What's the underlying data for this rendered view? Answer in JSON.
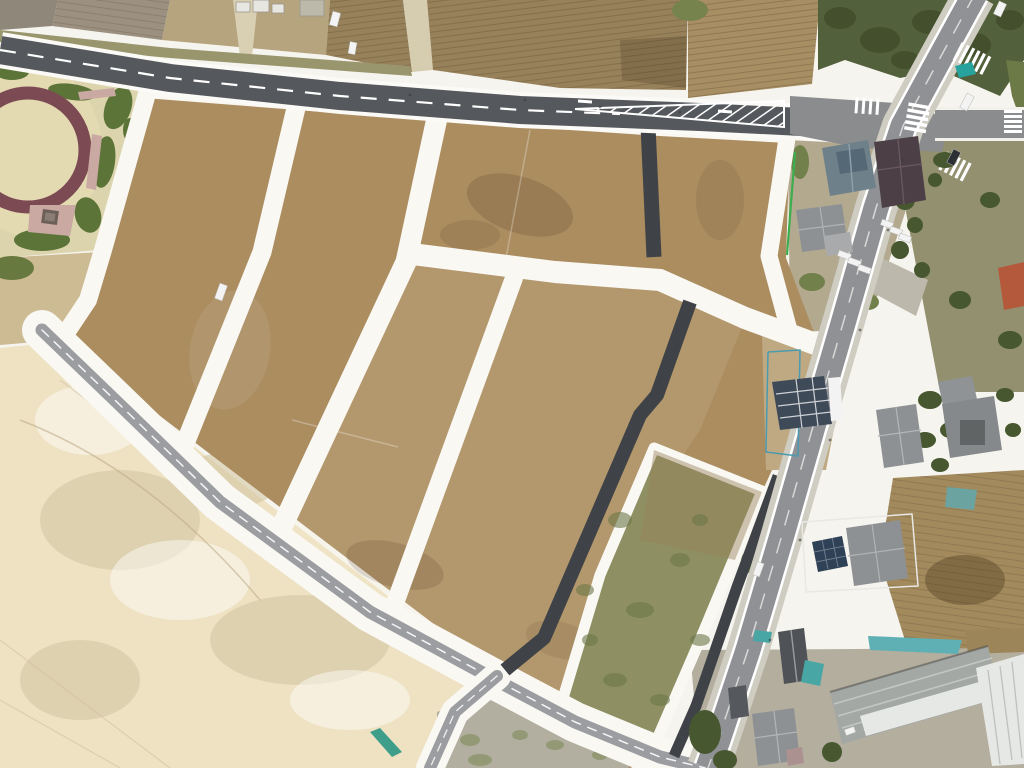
{
  "scene": {
    "description": "Aerial drone orthophoto of a residential land development under construction: bare brown building plots separated by white unpaved internal roads, a park with an oval maroon running track at top-left, plowed farm fields along the top, a large cream cleared field at bottom-left, and an existing paved road with houses, a warehouse and parked cars along the right side.",
    "park": {
      "track": "oval-maroon-track",
      "center": "sand-field",
      "border": "shrubs-and-pink-paths"
    },
    "plots": {
      "dirt_plots": 8,
      "vegetated_green_plots": 1,
      "mottled_gray_plots": 1
    },
    "roads": [
      "main-road-top",
      "existing-road-right",
      "boundary-road-southwest",
      "internal-white-roads",
      "new-dark-asphalt-roads"
    ],
    "road_markings": [
      "dashed-centerline",
      "chevron-island",
      "crosswalks",
      "teal-patches"
    ],
    "buildings": [
      "blue-gray-hip-house",
      "maroon-roof-house",
      "gray-roof-house",
      "orange-roof-house",
      "navy-construction-roof",
      "gray-hip-house",
      "complex-gray-house",
      "solar-panel-house",
      "dark-gray-gable-house",
      "large-warehouse",
      "white-building",
      "gray-hip-house-2",
      "farm-sheds"
    ],
    "vehicles": {
      "white_cars": 10,
      "dark_cars": 2,
      "white_truck": 1
    }
  },
  "palette": {
    "white_surface": "#f6f4ee",
    "white_road": "#faf8f3",
    "asphalt_main": "#55585c",
    "asphalt_new": "#3f4347",
    "road_gray": "#8f9194",
    "road_shoulder": "#cfccc2",
    "junction_concrete": "#8a8c8e",
    "boundary_asphalt": "#9b9da0",
    "lane_marking": "#ffffff",
    "dev_plot_brown": "#ab8d60",
    "plot_green": "#8e9064",
    "plot_green_speckle": "#6c7848",
    "plot_mottled": "#b2afa0",
    "cream_field": "#eee2c3",
    "tan_field": "#cdbb93",
    "furrow_field_dark": "#97815a",
    "furrow_field_mid": "#a78e63",
    "furrow_field_light": "#b5a47e",
    "plow_gray": "#9c9180",
    "plow_gray_dark": "#8f887a",
    "grass_margin": "#99966e",
    "woodland": "#53603c",
    "tree_dark": "#47572f",
    "scrub": "#93906f",
    "houses_zone_tan": "#b3a98f",
    "construction_tan": "#bfa983",
    "se_field": "#a28a5d",
    "park_sand": "#dcd4ad",
    "park_sand_inner": "#e3dab2",
    "park_track_maroon": "#7c4a52",
    "park_shrub": "#5d7439",
    "park_path_pink": "#c9a9a2",
    "house_blue_gray": "#6e8089",
    "house_maroon": "#4c4046",
    "house_gray": "#8e9194",
    "house_orange": "#b5593c",
    "house_slate_navy": "#3e4a58",
    "house_dark_gray": "#4f5357",
    "warehouse_gray": "#a3a8a4",
    "warehouse_white": "#e6e8e5",
    "solar_panel": "#2e4156",
    "teal_roof": "#48a7a4",
    "teal_patch": "#27a29c",
    "fence_green": "#3cae4e",
    "fence_blue": "#4a9ab0",
    "car_white": "#f2f3f2",
    "car_dark": "#2c2f34",
    "driveway": "#bcb8ab"
  }
}
